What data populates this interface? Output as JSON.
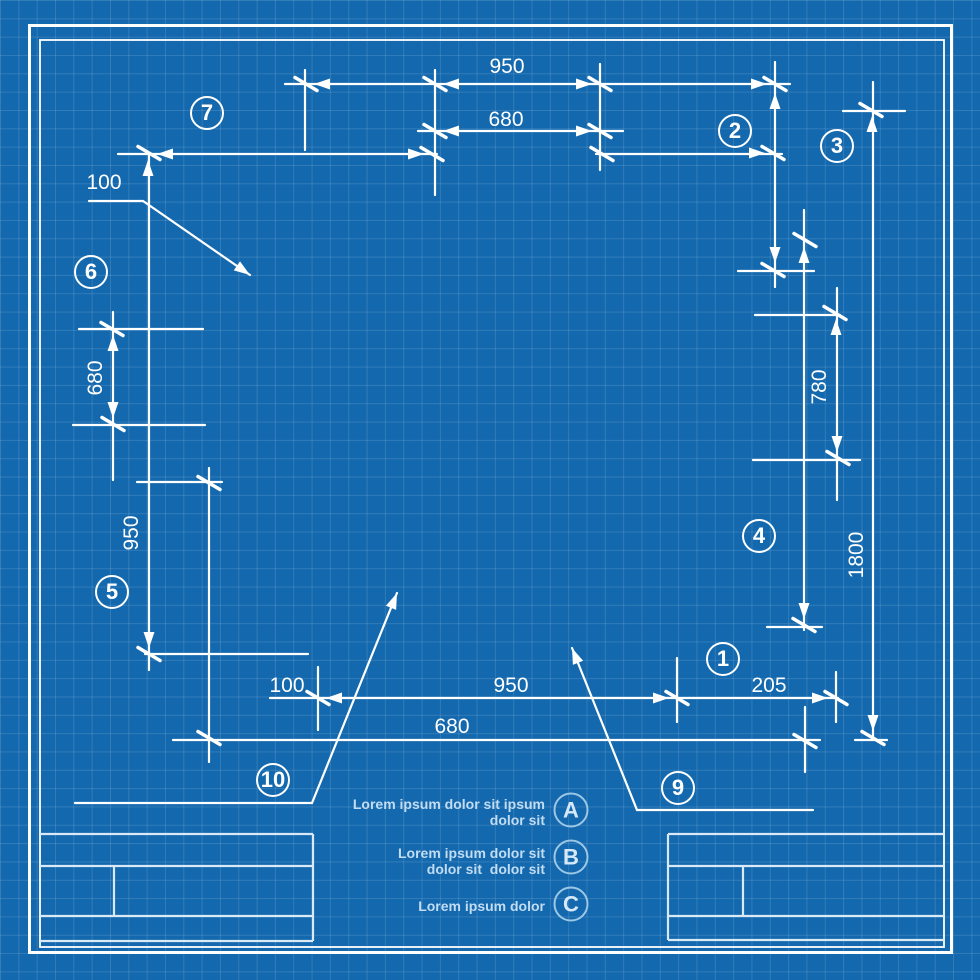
{
  "colors": {
    "background": "#1368ae",
    "grid_line": "rgba(255,255,255,0.13)",
    "drawing_line": "#ffffff",
    "pale_line": "#d9e9f5",
    "note_text": "#c2dcf2"
  },
  "dimension_labels": [
    {
      "text": "950",
      "x": 507,
      "y": 67,
      "rotated": false
    },
    {
      "text": "680",
      "x": 506,
      "y": 120,
      "rotated": false
    },
    {
      "text": "100",
      "x": 104,
      "y": 183,
      "rotated": false
    },
    {
      "text": "680",
      "x": 96,
      "y": 378,
      "rotated": true
    },
    {
      "text": "950",
      "x": 132,
      "y": 533,
      "rotated": true
    },
    {
      "text": "780",
      "x": 820,
      "y": 387,
      "rotated": true
    },
    {
      "text": "1800",
      "x": 857,
      "y": 555,
      "rotated": true
    },
    {
      "text": "100",
      "x": 287,
      "y": 686,
      "rotated": false
    },
    {
      "text": "950",
      "x": 511,
      "y": 686,
      "rotated": false
    },
    {
      "text": "205",
      "x": 769,
      "y": 686,
      "rotated": false
    },
    {
      "text": "680",
      "x": 452,
      "y": 727,
      "rotated": false
    }
  ],
  "callouts": [
    {
      "label": "1",
      "x": 723,
      "y": 659
    },
    {
      "label": "2",
      "x": 735,
      "y": 131
    },
    {
      "label": "3",
      "x": 837,
      "y": 146
    },
    {
      "label": "4",
      "x": 759,
      "y": 536
    },
    {
      "label": "5",
      "x": 112,
      "y": 592
    },
    {
      "label": "6",
      "x": 91,
      "y": 272
    },
    {
      "label": "7",
      "x": 207,
      "y": 113
    },
    {
      "label": "9",
      "x": 678,
      "y": 788
    },
    {
      "label": "10",
      "x": 273,
      "y": 780
    }
  ],
  "notes": [
    {
      "letter": "A",
      "lines": [
        "Lorem ipsum dolor sit ipsum",
        "dolor sit"
      ],
      "y": 812,
      "circle_x": 571,
      "circle_y": 810
    },
    {
      "letter": "B",
      "lines": [
        "Lorem ipsum dolor sit",
        "dolor sit  dolor sit"
      ],
      "y": 861,
      "circle_x": 571,
      "circle_y": 857
    },
    {
      "letter": "C",
      "lines": [
        "Lorem ipsum dolor"
      ],
      "y": 906,
      "circle_x": 571,
      "circle_y": 904
    }
  ]
}
